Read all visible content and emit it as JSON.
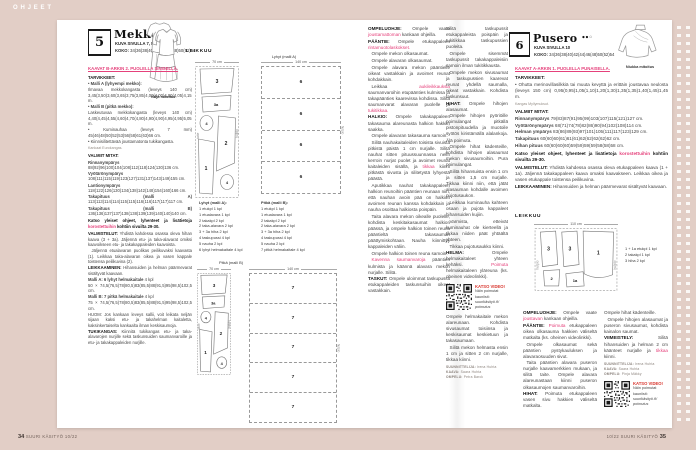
{
  "meta": {
    "section_label": "OHJEET",
    "footer_left_num": "34",
    "footer_left_text": "SUURI KÄSITYÖ 10/22",
    "footer_right_text": "10/22 SUURI KÄSITYÖ",
    "footer_right_num": "35"
  },
  "colors": {
    "background": "#e2cec6",
    "accent_pink": "#e5417b",
    "accent_red": "#d8342c",
    "paper": "#ffffff"
  },
  "video_box": {
    "label": "KATSO VIDEO!",
    "line1": "Näin poimutat",
    "line2": "kauniisti:",
    "link1": "suurikäsityö.fi/",
    "link2": "poimutus"
  },
  "dress": {
    "number": "5",
    "title": "Mekko",
    "dots_filled": "●●",
    "dots_open": "○",
    "photo_ref": "KUVA SIVULLA 7, 8 JA 9",
    "koko": "__KOKO:__ 34(36)38(40)42(44)46(48)50(52)54",
    "pattern_link": "KAAVAT B-ARKIN 2. PUOLELLA SINISELLÄ.",
    "fit_caption": "Väljä mitoitus",
    "leikkuu_label": "LEIKKUU",
    "col1": [
      {
        "h": "TARVIKKEET:"
      },
      {
        "t": "• __Malli A (lyhyempi mekko):__",
        "c": "flush"
      },
      {
        "t": "Ilmavaa mekkokangasta (leveys 140 cm) 3,45(3,50)3,60(3,65)3,75(3,85)4,00(4,00)4,00(4,05)4,15 m.",
        "c": "flush"
      },
      {
        "t": "• __Malli B (pitkä mekko):__",
        "c": "flush"
      },
      {
        "t": "Laskeutuvaa mekkokangasta (leveys 140 cm) 4,40(4,45)4,55(4,60)4,70(4,80)4,90(4,90)4,95(4,95)5,05 m.",
        "c": "flush"
      },
      {
        "t": "• Kuminauhaa (leveys 7 mm) 45(46)48(50)52(53)56(58)61(63)66 cm.",
        "c": "flush"
      },
      {
        "t": "• Kiinnisilitettävää joustamatonta tukikangasta.",
        "c": "flush"
      },
      {
        "t": "Kankaat Eurokangas.",
        "c": "tiny"
      },
      {
        "h": "VALMIIT MITAT:"
      },
      {
        "t": "__Rinnanympärys__ 88(92)96(100)104(108)112(118)124(130)136 cm.",
        "c": "flush"
      },
      {
        "t": "__Vyötärönympärys__ 108(111)115(119)123(127)131(137)143(149)155 cm.",
        "c": "flush"
      },
      {
        "t": "__Lantionympärys__ 118(122)126(130)134(138)142(148)154(160)166 cm.",
        "c": "flush"
      },
      {
        "t": "__Takapituus (malli A)__ 113(113)114(114)115(115)116(116)117(117)117 cm.",
        "c": "flush"
      },
      {
        "t": "__Takapituus (malli B)__ 136(136)137(137)138(138)139(139)140(140)140 cm.",
        "c": "flush"
      },
      {
        "t": "__Katso yleiset ohjeet, lyhenteet ja lisätietoja **korostettuihin** kohtiin sivuilta 29-30.__",
        "c": "note"
      },
      {
        "h": "VALMISTELUT:",
        "t": "Yhdistä kahdessa osassa oleva hihan kaava (3 + 3a). Jäljennä etu- ja taka-alavarat omiksi kaavoikseen etu- ja takakappaleiden kaavoista."
      },
      {
        "t": "Jäljennä etualavaran puolikas peilikuvaksi kaavasta (1). Leikkaa taka-alavaran oikea ja vasen kappale toistensa peilikuvina (2)."
      },
      {
        "h": "LEIKKAAMINEN:",
        "t": "Hihansuiden ja helman päärmevarat sisältyvät kaavaan."
      },
      {
        "t": "__Malli A: 6 lyhyt helmakaitale__ 4 kpl",
        "c": "flush"
      },
      {
        "t": "50 × 74,5(76,5)78(80,5)83(85,5)88(91,5)95(98,5)102,5 cm.",
        "c": "flush"
      },
      {
        "t": "__Malli B: 7 pitkä helmakaitale__ 4 kpl",
        "c": "flush"
      },
      {
        "t": "75 × 74,5(76,5)78(80,5)83(85,5)88(91,5)95(98,5)102,5 cm.",
        "c": "flush"
      },
      {
        "t": "HUOM: Jos kankaan leveys sallii, voit leikata neljän sijaan kaksi etu- ja takahelman kaitaletta, kaksinkertaiselta kankaalta ilman keskisaumoja.",
        "c": "flush"
      },
      {
        "h": "TUKIKANGAS:",
        "t": "Kiinnitä tukikangas etu- ja taka-alavarojen nurjille sekä taskunsuiden saumanvaroille ja etu- ja takakappaleiden nurjille."
      }
    ],
    "col2": [
      {
        "h": "OMPELUOHJE:",
        "t": "Ompele vaate **joustamattoman** kankaan ohjeilla."
      },
      {
        "h": "PÄÄNTIE:",
        "t": "Ompele etukappaleen **rintamuotolaskokset.**"
      },
      {
        "t": "Ompele mekon olkasaumat."
      },
      {
        "t": "Ompele alavaran olkasaumat."
      },
      {
        "t": "Ompele alavara mekon pääntielle oikeat vastakkain ja avoimet reunat kohdakkain."
      },
      {
        "t": "Leikkaa **aukileikkauksia** saumanvaroihin etupäänties kulmissa ja takapäänties kaarevissa kohdissa. Silitä saumanvarat alavaran puolelle ja **tukitikkaa.**"
      },
      {
        "h": "HALKIO:",
        "t": "Ompele takakappaleen takasauma alareunasta halkion hakkiin saakka."
      },
      {
        "t": "Ompele alavaran takasauma samoin."
      },
      {
        "t": "Silitä nauhakaitaleiden toisista sivuista pitkistä päistä 1 cm nurjalle. Silitä nauhat sitten pituussuunnassa nelin kerroin nurjat puolet ja avoimet reunat kaitaleiden sisällä, ja **tikkaa** kiinni pitkästä sivusta ja silitetystä lyhyestä päästä."
      },
      {
        "t": "Aputikkaa nauhat takakappaleen halkion reunoihin pääntien reunaan niin, että nauhan avoin pää on halkion avoimen reunan kanssa kohdakkain ja nauha osoittaa halkiosta poispäin."
      },
      {
        "t": "Taita alavara mekon oikealle puolelle, kohdista keskitakasaumat halkion päässä, ja ompele halkion toinen reuna pääntieltä takasauman päättymiskohtaan. Nauha kiinnittyy kappaleiden väliin."
      },
      {
        "t": "Ompele halkion toinen reuna samoin."
      },
      {
        "t": "**Kavenna saumanvaroja** pääntien kulmista ja käännä alavara mekon nurjalle. Silitä."
      },
      {
        "h": "TASKUT:",
        "t": "Ompele uloimmat taskupussit etukappaleiden taskunsuihin oikeat vastakkain."
      }
    ],
    "col3_top": [
      {
        "t": "Silitä taskupussit etukappaleista poispäin ja tukitikkaa taskupussien puoleita.",
        "c": "flush"
      },
      {
        "t": "Ompele sisemmät taskupussit takakappaleisiin samoin ilman tukitikkausta."
      },
      {
        "t": "Ompele mekon sivusaumat ja taskupussien kaarevat reunat yhdellä saumalla, oikeat vastakkain. Kohdista taskunsuut."
      },
      {
        "h": "HIHAT:",
        "t": "Ompele hihojen alasaumat."
      },
      {
        "t": "Ompele hihojen pyöriöille poimulangat pitkällä pistonpituudella ja muotoile syötös kiristämällä alalankoja. Älä poimuta."
      },
      {
        "t": "Ompele hihat kädenteille, kohdista hihojen alasaumat mekon sivusaumoihin. Pura poimulangat."
      },
      {
        "t": "Silitä hihansuista ensin 1 cm ja sitten 1,5 cm nurjalle. Tikkaa kiinni niin, että jätät alasauman kohdalle avoimen pujotusaukon."
      },
      {
        "t": "Leikkaa kuminauha kahteen osaan ja pujota kappaleet hihansuiden kujiin."
      },
      {
        "t": "Varmista, etteivät kuminauhat ole kierteellä ja tikkaa niiden päät yhtäältä yhteen."
      },
      {
        "t": "Tikkaa pujotusaukko kiinni."
      },
      {
        "h": "HELMA:",
        "t": "Ompele helmakaitaleet yhteen kehäksi. **Poimuta** helmakaitaleen yläreuna (ks. oheinen videolinkki)."
      }
    ],
    "col3_bottom": [
      {
        "t": "Ompele helmakaitale mekon alareunaan. Kohdista sivusaumat toisiinsa ja keskisaumat keskietuun ja takasaumaan.",
        "c": "flush"
      },
      {
        "t": "Silitä mekon helmasta ensin 1 cm ja sitten 2 cm nurjalle, tikkaa kiinni."
      }
    ],
    "credits": [
      {
        "role": "SUUNNITTELIJA:",
        "name": "Irena Huhta"
      },
      {
        "role": "KAAVA:",
        "name": "Saara Huhta"
      },
      {
        "role": "OMPELU:",
        "name": "Petra Barck"
      }
    ],
    "cutting": {
      "caption_a": "Lyhyt (malli A)",
      "caption_b": "Pitkä (malli B)",
      "layout_width": "70 cm",
      "strips_width": "140 cm",
      "fold": "taite",
      "selvage": "hulpio",
      "pieces": [
        "3",
        "3a",
        "4",
        "2",
        "1",
        "4"
      ],
      "strips_a": [
        "6",
        "6",
        "6",
        "6"
      ],
      "strips_b": [
        "7",
        "7",
        "7",
        "7",
        "7"
      ],
      "list_a_title": "Lyhyt (malli A):",
      "list_a": [
        "1 etukpl 1 kpl",
        "1 etualavara 1 kpl",
        "2 takakpl 2 kpl",
        "2 taka-alavara 2 kpl",
        "3 + 3a hiha 2 kpl",
        "4 taskupussi 4 kpl",
        "5 nauha 2 kpl",
        "6 lyhyt helmakaitale 4 kpl"
      ],
      "list_b_title": "Pitkä (malli B):",
      "list_b": [
        "1 etukpl 1 kpl",
        "1 etualavara 1 kpl",
        "2 takakpl 2 kpl",
        "2 taka-alavara 2 kpl",
        "3 + 3a hiha 2 kpl",
        "4 taskupussi 4 kpl",
        "5 nauha 2 kpl",
        "7 pitkä helmakaitale 4 kpl"
      ]
    }
  },
  "blouse": {
    "number": "6",
    "title": "Pusero",
    "dots_filled": "●●",
    "dots_open": "○",
    "photo_ref": "KUVA SIVULLA 10",
    "koko": "__KOKO:__ 34(36)38(40)42(44)46(48)50(52)54",
    "pattern_link": "KAAVAT A-ARKIN 1. PUOLELLA PUNAISELLA.",
    "fit_caption": "Niukka mitoitus",
    "leikkuu_label": "LEIKKUU",
    "intro": [
      {
        "h": "TARVIKKEET:"
      },
      {
        "t": "• Ohutta merinovillasilkkiä tai muuta kevyttä ja erittäin joustavaa neulosta (leveys 150 cm) 0,95(0,95)1,05(1,10)1,20(1,30)1,35(1,35)1,40(1,45)1,45 m.",
        "c": "flush"
      },
      {
        "t": "Kangas Myllymuksut.",
        "c": "tiny"
      },
      {
        "h": "VALMIIT MITAT:"
      },
      {
        "t": "__Rinnanympärys__ 79(83)87(91)95(99)103(107)115(121)127 cm.",
        "c": "flush"
      },
      {
        "t": "__Vyötärönympärys__ 68(71)74(78)82(86)90(94)102(108)114 cm.",
        "c": "flush"
      },
      {
        "t": "__Helman ympärys__ 83(86)89(93)97(101)105(111)117(123)129 cm.",
        "c": "flush"
      },
      {
        "t": "__Takapituus__ 60(60)60(61)61(61)62(62)62(62)62 cm.",
        "c": "flush"
      },
      {
        "t": "__Hihan pituus__ 60(60)60(60)59(59)59(59)58(58)58 cm.",
        "c": "flush"
      },
      {
        "t": "__Katso yleiset ohjeet, lyhenteet ja lisätietoja **korostettuihin** kohtiin sivuilta 29-30.__",
        "c": "note"
      },
      {
        "h": "VALMISTELUT:",
        "t": "Yhdistä kahdessa osassa oleva etukappaleen kaava (1 + 1a). Jäljennä takakappaleen kaava omaksi kaavakseen. Leikkaa oikea ja vasen etukappale toistensa peilikuvina."
      },
      {
        "h": "LEIKKAAMINEN:",
        "t": "Hihansuiden ja helman päärmevarat sisältyvät kaavaan."
      }
    ],
    "colA": [
      {
        "h": "OMPELUOHJE:",
        "t": "Ompele vaate **joustavan** kankaan ohjeilla."
      },
      {
        "h": "PÄÄNTIE:",
        "t": "**Poimuta** etukappaleen oikea olkasauma hakkien väliseltä matkalta (ks. oheinen videolinkki)."
      },
      {
        "t": "Ompele olkasaumat sekä pääntien pystykauluksen ja alavaraosuuden sivut."
      },
      {
        "t": "Taita pääntien alavara puseron nurjalle kaavamerkkien mukaan, ja silitä taite. Ompele alavara alareunastaan kiinni puseron olkasaumojen saumanvaroihin."
      },
      {
        "h": "HIHAT:",
        "t": "Poimuta etukappaleen vasen sivu hakkien väliseltä matkalta."
      }
    ],
    "colB": [
      {
        "t": "Ompele hihat kädenteille.",
        "c": "flush"
      },
      {
        "t": "Ompele hihojen alasaumat ja puseron sivusaumat, kohdista kainalon saumat."
      },
      {
        "h": "VIIMEISTELY:",
        "t": "Silitä hihansuiden ja helman 2 cm käänteet nurjalle ja **tikkaa** kiinni."
      }
    ],
    "credits": [
      {
        "role": "SUUNNITTELIJA:",
        "name": "Irena Huhta"
      },
      {
        "role": "KAAVA:",
        "name": "Saara Huhta"
      },
      {
        "role": "OMPELU:",
        "name": "Pinja Mäkky"
      }
    ],
    "cutting": {
      "layout_width": "110 cm",
      "selvage": "hulpio",
      "pieces": [
        "3",
        "3",
        "1",
        "2",
        "1a"
      ],
      "list": [
        "1 + 1a etukpl 1 kpl",
        "2 takakpl 1 kpl",
        "3 hiha 2 kpl"
      ]
    }
  }
}
